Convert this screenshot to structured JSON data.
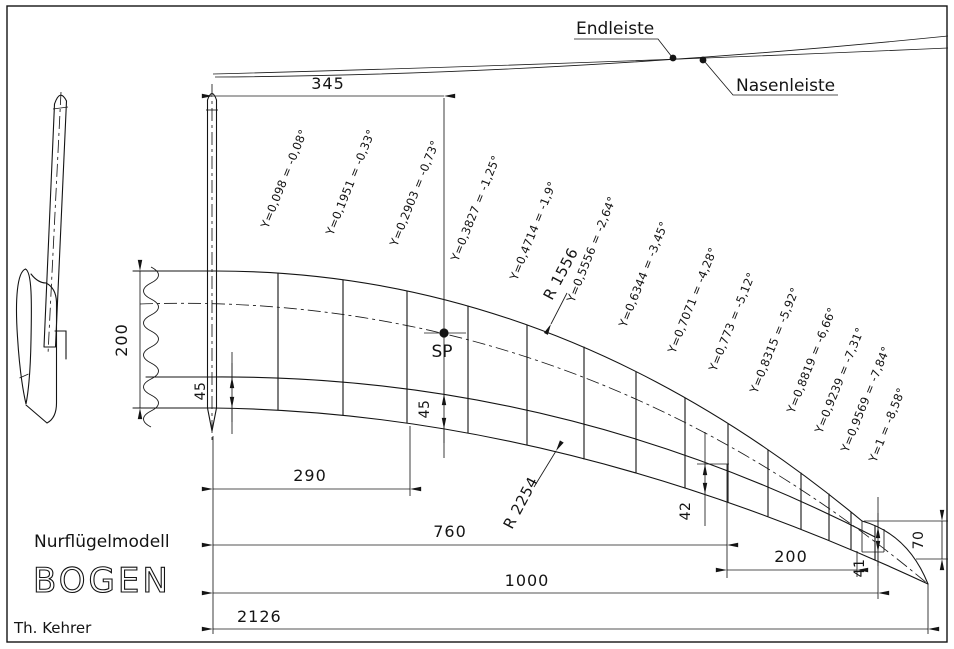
{
  "header_curves": {
    "endleiste_label": "Endleiste",
    "nasenleiste_label": "Nasenleiste"
  },
  "planform": {
    "sp_label": "SP",
    "radius_upper": "R 1556",
    "radius_lower": "R 2254",
    "rib_labels": [
      "Y=0,098 = -0,08°",
      "Y=0,1951 = -0,33°",
      "Y=0,2903 = -0,73°",
      "Y=0,3827 = -1,25°",
      "Y=0,4714 = -1,9°",
      "Y=0,5556 = -2,64°",
      "Y=0,6344 = -3,45°",
      "Y=0,7071 = -4,28°",
      "Y=0,773 = -5,12°",
      "Y=0,8315 = -5,92°",
      "Y=0,8819 = -6,66°",
      "Y=0,9239 = -7,31°",
      "Y=0,9569 = -7,84°",
      "Y=1 = -8,58°"
    ]
  },
  "dimensions": {
    "d345": "345",
    "root_chord": "200",
    "strip_root": "45",
    "strip_sp": "45",
    "d290": "290",
    "d760": "760",
    "d1000": "1000",
    "d2126": "2126",
    "tip_200": "200",
    "tip_42": "42",
    "tip_41": "41",
    "tip_70": "70"
  },
  "title_block": {
    "model_type": "Nurflügelmodell",
    "model_name": "BOGEN",
    "author": "Th. Kehrer"
  }
}
